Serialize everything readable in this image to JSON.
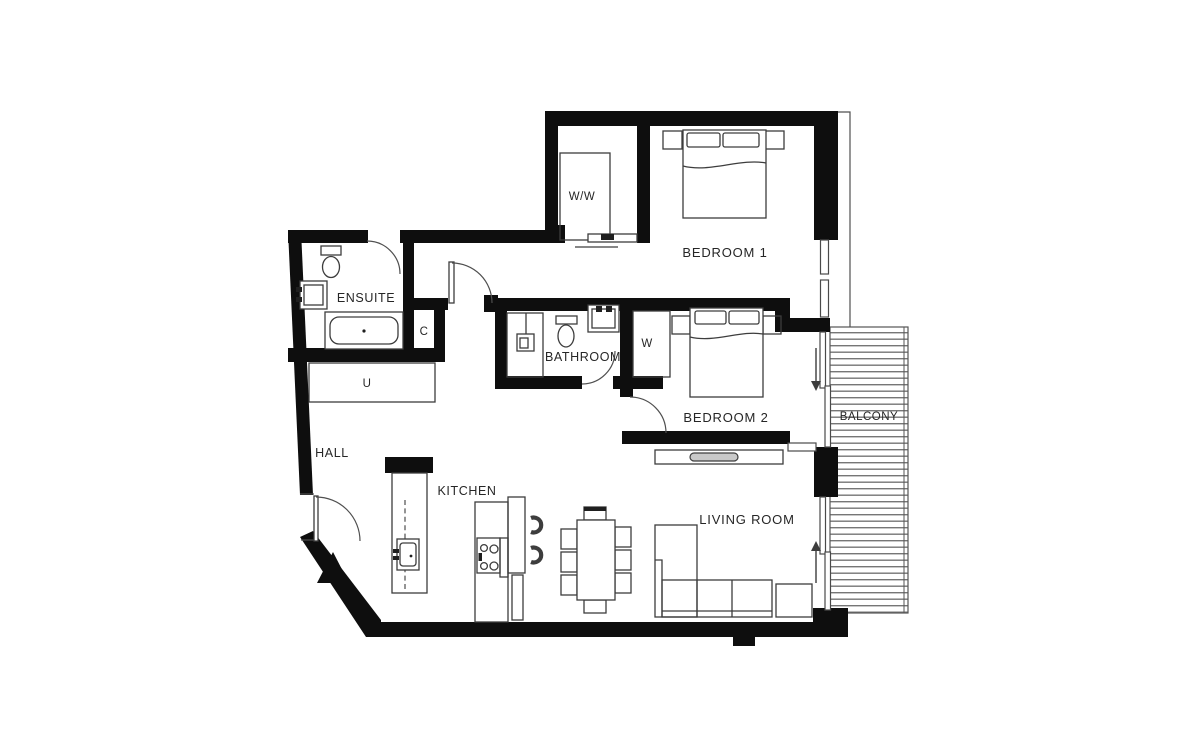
{
  "labels": {
    "bedroom1": "BEDROOM 1",
    "bedroom2": "BEDROOM 2",
    "bathroom": "BATHROOM",
    "ensuite": "ENSUITE",
    "kitchen": "KITCHEN",
    "living_room": "LIVING ROOM",
    "hall": "HALL",
    "balcony": "BALCONY",
    "walkin_wardrobe": "W/W",
    "wardrobe": "W",
    "cupboard": "C",
    "utility": "U"
  },
  "colors": {
    "background": "#ffffff",
    "walls": "#0e0e0e",
    "furniture_lines": "#3d3d3d",
    "deck_stripes": "#767676",
    "text": "#262626"
  },
  "icons": [
    {
      "name": "double-bed-icon",
      "room": "BEDROOM 1"
    },
    {
      "name": "double-bed-icon",
      "room": "BEDROOM 2"
    },
    {
      "name": "wardrobe-icon",
      "room": "W/W"
    },
    {
      "name": "bathtub-icon",
      "room": "ENSUITE"
    },
    {
      "name": "toilet-icon",
      "room": "ENSUITE"
    },
    {
      "name": "washbasin-icon",
      "room": "ENSUITE"
    },
    {
      "name": "shower-icon",
      "room": "BATHROOM"
    },
    {
      "name": "toilet-icon",
      "room": "BATHROOM"
    },
    {
      "name": "washbasin-icon",
      "room": "BATHROOM"
    },
    {
      "name": "kitchen-counter-icon",
      "room": "KITCHEN"
    },
    {
      "name": "kitchen-sink-icon",
      "room": "KITCHEN"
    },
    {
      "name": "hob-icon",
      "room": "KITCHEN"
    },
    {
      "name": "bar-stool-icon",
      "count": 2
    },
    {
      "name": "dining-table-icon",
      "seats": 8
    },
    {
      "name": "sofa-icon",
      "room": "LIVING ROOM"
    },
    {
      "name": "side-table-icon",
      "room": "LIVING ROOM"
    },
    {
      "name": "tv-unit-icon",
      "room": "LIVING ROOM"
    },
    {
      "name": "entrance-marker-icon",
      "room": "HALL"
    },
    {
      "name": "sliding-door-arrow-icon",
      "count": 2
    },
    {
      "name": "door-swing-arc",
      "count": 5
    }
  ]
}
